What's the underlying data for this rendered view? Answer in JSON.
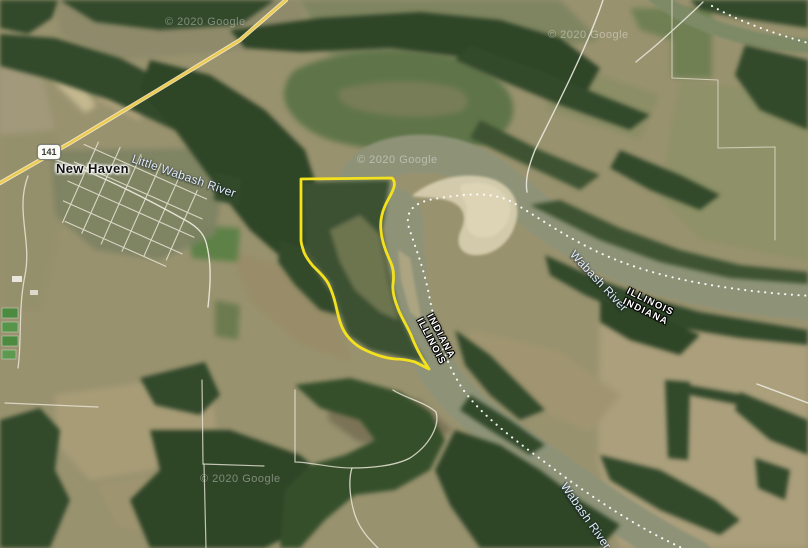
{
  "map": {
    "kind": "satellite-map",
    "labels": {
      "town": "New Haven",
      "route_shield": "141",
      "little_wabash": "Little Wabash River",
      "wabash_upper": "Wabash River",
      "wabash_lower": "Wabash River",
      "state_pair_left": {
        "line1": "INDIANA",
        "line2": "ILLINOIS"
      },
      "state_pair_right": {
        "line1": "ILLINOIS",
        "line2": "INDIANA"
      }
    },
    "watermark": "© 2020 Google",
    "overlay": {
      "parcel_outline_color": "#f4e11d",
      "state_line_color": "#ffffff",
      "highway_color": "#ecc94f",
      "water_color": "#8e9378",
      "sandbar_color": "#d2caaa"
    }
  }
}
